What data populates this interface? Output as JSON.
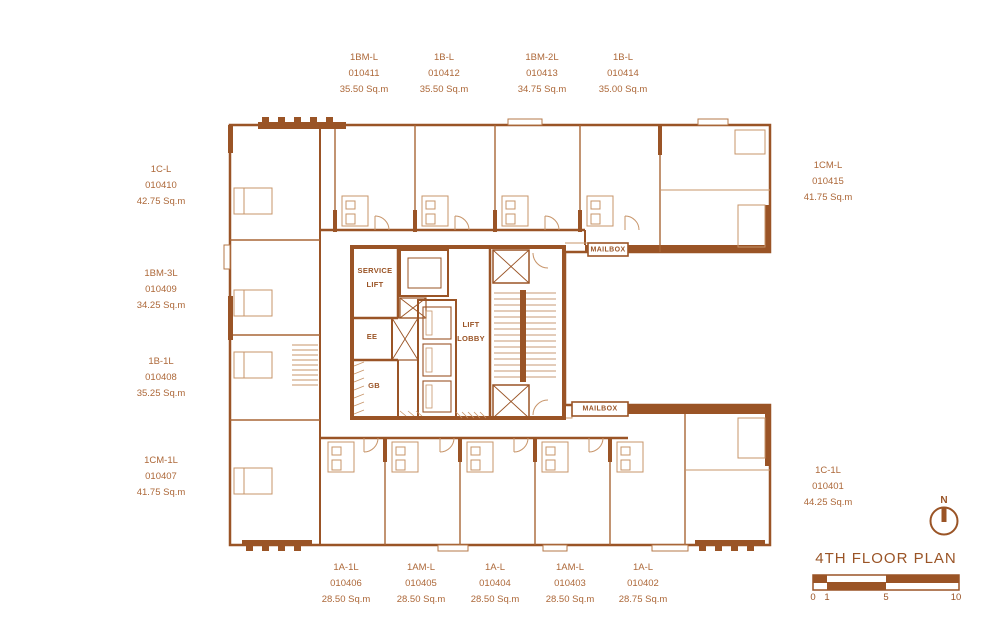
{
  "title": "4TH FLOOR PLAN",
  "compass": {
    "north_label": "N"
  },
  "scale_bar": {
    "ticks": [
      "0",
      "1",
      "5",
      "10"
    ]
  },
  "colors": {
    "wall": "#9a5426",
    "line_medium": "#a96636",
    "line_light": "#c79469",
    "text": "#ad6839"
  },
  "core": {
    "service_lift_line1": "SERVICE",
    "service_lift_line2": "LIFT",
    "ee": "EE",
    "gb": "GB",
    "lift_lobby_line1": "LIFT",
    "lift_lobby_line2": "LOBBY",
    "mailbox_top": "MAILBOX",
    "mailbox_bottom": "MAILBOX"
  },
  "units": [
    {
      "name": "1BM-L",
      "number": "010411",
      "area": "35.50 Sq.m"
    },
    {
      "name": "1B-L",
      "number": "010412",
      "area": "35.50 Sq.m"
    },
    {
      "name": "1BM-2L",
      "number": "010413",
      "area": "34.75 Sq.m"
    },
    {
      "name": "1B-L",
      "number": "010414",
      "area": "35.00 Sq.m"
    },
    {
      "name": "1C-L",
      "number": "010410",
      "area": "42.75 Sq.m"
    },
    {
      "name": "1BM-3L",
      "number": "010409",
      "area": "34.25 Sq.m"
    },
    {
      "name": "1B-1L",
      "number": "010408",
      "area": "35.25 Sq.m"
    },
    {
      "name": "1CM-1L",
      "number": "010407",
      "area": "41.75 Sq.m"
    },
    {
      "name": "1CM-L",
      "number": "010415",
      "area": "41.75 Sq.m"
    },
    {
      "name": "1C-1L",
      "number": "010401",
      "area": "44.25 Sq.m"
    },
    {
      "name": "1A-1L",
      "number": "010406",
      "area": "28.50 Sq.m"
    },
    {
      "name": "1AM-L",
      "number": "010405",
      "area": "28.50 Sq.m"
    },
    {
      "name": "1A-L",
      "number": "010404",
      "area": "28.50 Sq.m"
    },
    {
      "name": "1AM-L",
      "number": "010403",
      "area": "28.50 Sq.m"
    },
    {
      "name": "1A-L",
      "number": "010402",
      "area": "28.75 Sq.m"
    }
  ]
}
